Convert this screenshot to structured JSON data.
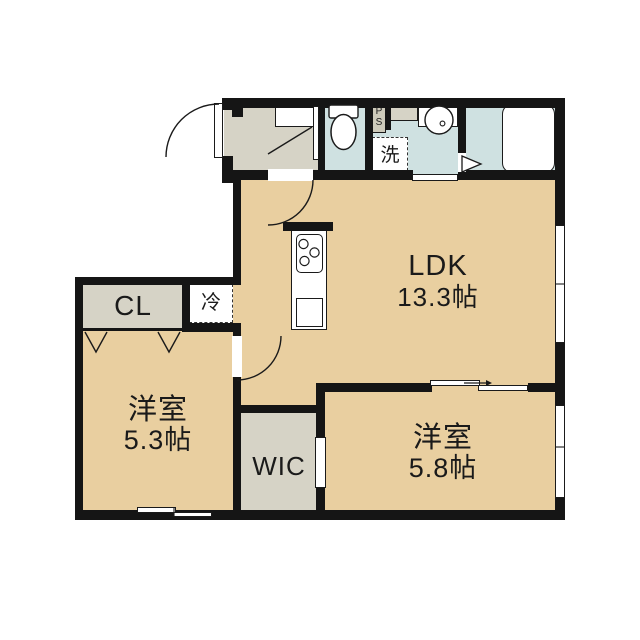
{
  "floorplan": {
    "title": "1LDK+WIC apartment floor plan",
    "rooms": {
      "ldk": {
        "name": "LDK",
        "area": "13.3帖"
      },
      "bedroom_west_1": {
        "name": "洋室",
        "area": "5.3帖"
      },
      "bedroom_west_2": {
        "name": "洋室",
        "area": "5.8帖"
      },
      "wic": {
        "name": "WIC"
      },
      "closet": {
        "name": "CL"
      },
      "refrigerator_space": {
        "name": "冷"
      },
      "washer_space": {
        "name": "洗"
      },
      "pipe_space": {
        "line1": "P",
        "line2": "S"
      }
    },
    "fixtures": [
      "bathtub",
      "toilet",
      "wash-basin",
      "kitchen-stove",
      "kitchen-sink",
      "entry-door",
      "shoe-cabinet"
    ],
    "colors": {
      "room_tan": "#e9cfa0",
      "service_gray": "#d6d3c6",
      "wet_blue": "#cfe1e1",
      "ps_gray": "#cdcaba",
      "wall": "#151515",
      "background": "#ffffff"
    }
  }
}
